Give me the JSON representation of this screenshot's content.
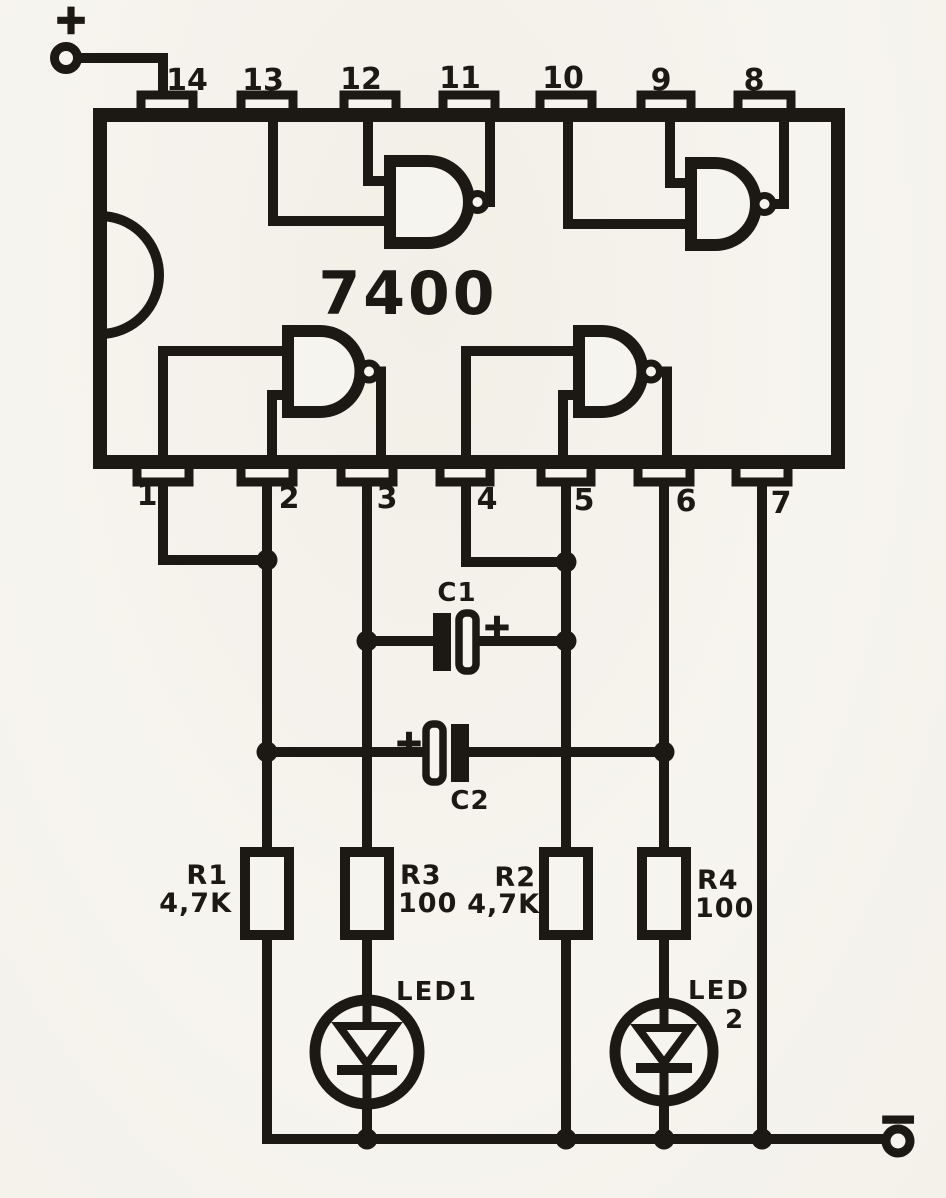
{
  "ic": {
    "label": "7400",
    "top_pins": [
      "14",
      "13",
      "12",
      "11",
      "10",
      "9",
      "8"
    ],
    "bottom_pins": [
      "1",
      "2",
      "3",
      "4",
      "5",
      "6",
      "7"
    ]
  },
  "power": {
    "positive": "+",
    "negative": "−"
  },
  "capacitors": {
    "c1": {
      "label": "C1",
      "polarity": "+"
    },
    "c2": {
      "label": "C2",
      "polarity": "+"
    }
  },
  "resistors": {
    "r1": {
      "name": "R1",
      "value": "4,7K"
    },
    "r3": {
      "name": "R3",
      "value": "100"
    },
    "r2": {
      "name": "R2",
      "value": "4,7K"
    },
    "r4": {
      "name": "R4",
      "value": "100"
    }
  },
  "leds": {
    "led1": {
      "label": "LED1"
    },
    "led2": {
      "label": "LED",
      "number": "2"
    }
  },
  "colors": {
    "ink": "#1c1813",
    "paper": "#f6f4ee"
  }
}
